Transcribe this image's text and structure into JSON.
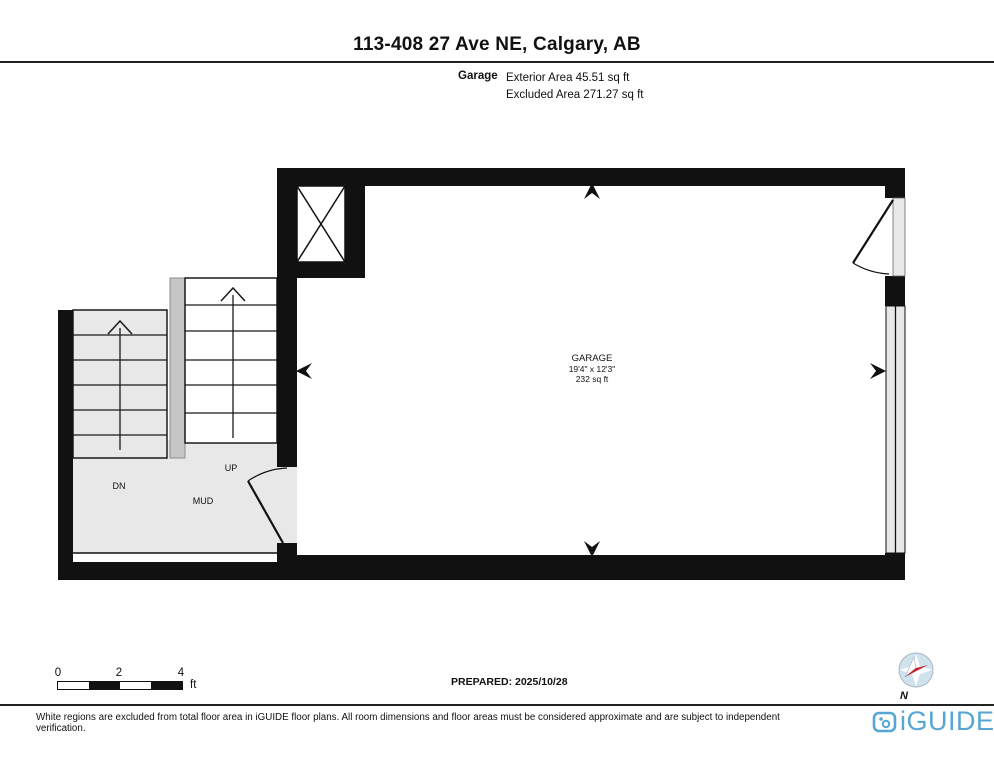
{
  "header": {
    "title": "113-408 27 Ave NE, Calgary, AB",
    "floor_label": "Garage",
    "exterior_area": "Exterior Area 45.51 sq ft",
    "excluded_area": "Excluded Area 271.27 sq ft"
  },
  "plan": {
    "room_name": "GARAGE",
    "room_dimensions": "19'4\" x 12'3\"",
    "room_area": "232 sq ft",
    "label_dn": "DN",
    "label_up": "UP",
    "label_mud": "MUD"
  },
  "scale_bar": {
    "ticks": [
      "0",
      "2",
      "4"
    ],
    "unit": "ft"
  },
  "prepared_label": "PREPARED: 2025/10/28",
  "compass_label": "N",
  "footer": {
    "disclaimer": "White regions are excluded from total floor area in iGUIDE floor plans. All room dimensions and floor areas must be considered approximate and are subject to independent verification.",
    "brand": "iGUIDE"
  },
  "colors": {
    "wall": "#111111",
    "excluded_fill": "#e8e8e8",
    "divider_fill": "#c6c6c6",
    "brand_blue": "#55a6d3",
    "compass_red": "#c4262e",
    "compass_blue": "#cfe3ef"
  }
}
